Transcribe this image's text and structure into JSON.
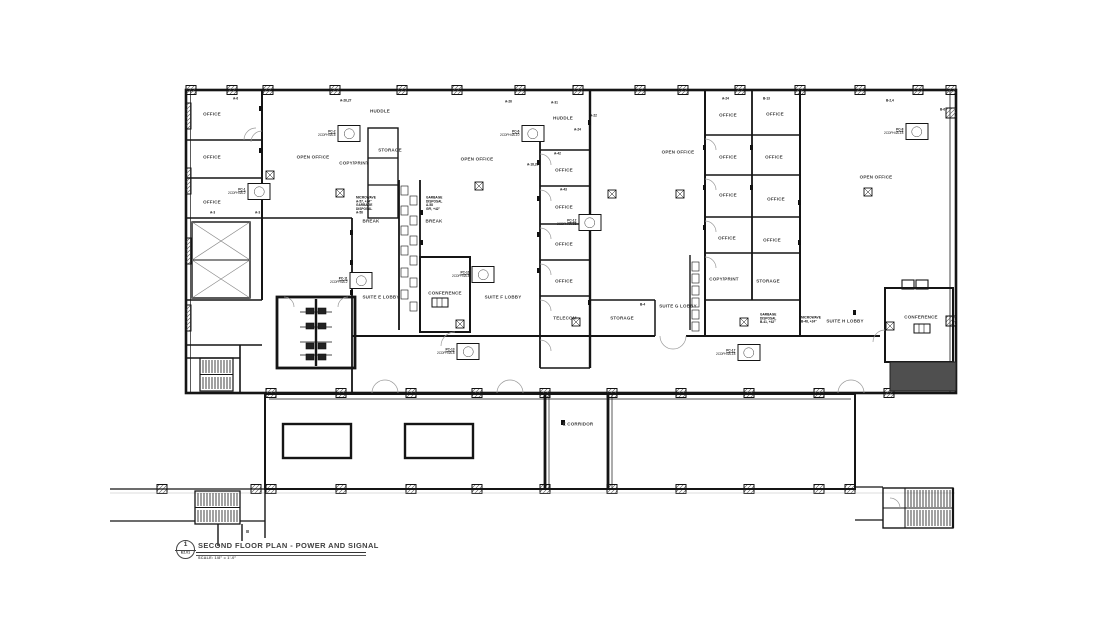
{
  "sheet": {
    "background": "#ffffff",
    "ink": "#1a1a1a",
    "muted": "#8a8a8a",
    "fill_dark": "#4f4f4f"
  },
  "title_block": {
    "detail_number": "1",
    "sheet_ref": "E2.01",
    "title": "SECOND FLOOR PLAN - POWER AND SIGNAL",
    "scale": "SCALE: 1/8\" = 1'-0\""
  },
  "rooms": [
    {
      "label": "OFFICE",
      "x": 212,
      "y": 114
    },
    {
      "label": "OFFICE",
      "x": 212,
      "y": 157
    },
    {
      "label": "OFFICE",
      "x": 212,
      "y": 202
    },
    {
      "label": "HUDDLE",
      "x": 380,
      "y": 111
    },
    {
      "label": "OPEN OFFICE",
      "x": 313,
      "y": 157
    },
    {
      "label": "COPY/PRINT",
      "x": 354,
      "y": 163
    },
    {
      "label": "STORAGE",
      "x": 390,
      "y": 150
    },
    {
      "label": "BREAK",
      "x": 371,
      "y": 221
    },
    {
      "label": "BREAK",
      "x": 434,
      "y": 221
    },
    {
      "label": "HUDDLE",
      "x": 563,
      "y": 118
    },
    {
      "label": "OPEN OFFICE",
      "x": 477,
      "y": 159
    },
    {
      "label": "OFFICE",
      "x": 564,
      "y": 170
    },
    {
      "label": "OFFICE",
      "x": 564,
      "y": 207
    },
    {
      "label": "OFFICE",
      "x": 564,
      "y": 244
    },
    {
      "label": "OFFICE",
      "x": 564,
      "y": 281
    },
    {
      "label": "TELECOM",
      "x": 565,
      "y": 318
    },
    {
      "label": "CONFERENCE",
      "x": 445,
      "y": 293
    },
    {
      "label": "SUITE E LOBBY",
      "x": 381,
      "y": 297
    },
    {
      "label": "SUITE F LOBBY",
      "x": 503,
      "y": 297
    },
    {
      "label": "OPEN OFFICE",
      "x": 678,
      "y": 152
    },
    {
      "label": "OFFICE",
      "x": 728,
      "y": 115
    },
    {
      "label": "OFFICE",
      "x": 775,
      "y": 114
    },
    {
      "label": "OFFICE",
      "x": 728,
      "y": 157
    },
    {
      "label": "OFFICE",
      "x": 774,
      "y": 157
    },
    {
      "label": "OFFICE",
      "x": 728,
      "y": 195
    },
    {
      "label": "OFFICE",
      "x": 776,
      "y": 199
    },
    {
      "label": "OFFICE",
      "x": 727,
      "y": 238
    },
    {
      "label": "OFFICE",
      "x": 772,
      "y": 240
    },
    {
      "label": "COPY/PRINT",
      "x": 724,
      "y": 279
    },
    {
      "label": "STORAGE",
      "x": 768,
      "y": 281
    },
    {
      "label": "STORAGE",
      "x": 622,
      "y": 318
    },
    {
      "label": "SUITE G LOBBY",
      "x": 678,
      "y": 306
    },
    {
      "label": "SUITE H LOBBY",
      "x": 845,
      "y": 321
    },
    {
      "label": "OPEN OFFICE",
      "x": 876,
      "y": 177
    },
    {
      "label": "CONFERENCE",
      "x": 921,
      "y": 317
    },
    {
      "label": "E CORRIDOR",
      "x": 578,
      "y": 424
    }
  ],
  "annotations": [
    {
      "x": 233,
      "y": 97,
      "lines": [
        "A-6"
      ]
    },
    {
      "x": 340,
      "y": 99,
      "lines": [
        "A-26,27"
      ]
    },
    {
      "x": 505,
      "y": 100,
      "lines": [
        "A-26"
      ]
    },
    {
      "x": 551,
      "y": 101,
      "lines": [
        "A-31"
      ]
    },
    {
      "x": 590,
      "y": 114,
      "lines": [
        "A-22"
      ]
    },
    {
      "x": 574,
      "y": 128,
      "lines": [
        "A-24"
      ]
    },
    {
      "x": 527,
      "y": 163,
      "lines": [
        "A-18,20"
      ]
    },
    {
      "x": 554,
      "y": 152,
      "lines": [
        "A-42"
      ]
    },
    {
      "x": 560,
      "y": 188,
      "lines": [
        "A-43"
      ]
    },
    {
      "x": 722,
      "y": 97,
      "lines": [
        "A-24"
      ]
    },
    {
      "x": 763,
      "y": 97,
      "lines": [
        "B-13"
      ]
    },
    {
      "x": 886,
      "y": 99,
      "lines": [
        "B-2,4"
      ]
    },
    {
      "x": 940,
      "y": 108,
      "lines": [
        "B-6"
      ]
    },
    {
      "x": 210,
      "y": 211,
      "lines": [
        "A-3"
      ]
    },
    {
      "x": 255,
      "y": 211,
      "lines": [
        "A-3"
      ]
    },
    {
      "x": 356,
      "y": 196,
      "lines": [
        "MICROWAVE",
        "A-57, +24\"",
        "GARBAGE",
        "DISPOSAL",
        "A-56"
      ]
    },
    {
      "x": 426,
      "y": 196,
      "lines": [
        "GARBAGE",
        "DISPOSAL",
        "A-58",
        "GFI, +42\""
      ]
    },
    {
      "x": 760,
      "y": 313,
      "lines": [
        "GARBAGE",
        "DISPOSAL",
        "B-41, +42\""
      ]
    },
    {
      "x": 801,
      "y": 316,
      "lines": [
        "MICROWAVE",
        "B-48, +24\""
      ]
    },
    {
      "x": 640,
      "y": 303,
      "lines": [
        "B-4"
      ]
    }
  ],
  "notes": [
    {
      "x": 318,
      "y": 125,
      "tag": "PC-2",
      "sub": "2CDPH4A-6"
    },
    {
      "x": 500,
      "y": 125,
      "tag": "PC-6",
      "sub": "2CDPH4A-10"
    },
    {
      "x": 884,
      "y": 123,
      "tag": "PC-8",
      "sub": "2CDPH4A-18"
    },
    {
      "x": 228,
      "y": 183,
      "tag": "PC-1",
      "sub": "2CDPH4A-2"
    },
    {
      "x": 330,
      "y": 272,
      "tag": "PC-11",
      "sub": "2CDPH4A-2"
    },
    {
      "x": 452,
      "y": 266,
      "tag": "PC-10",
      "sub": "2CDPH4A-8"
    },
    {
      "x": 557,
      "y": 214,
      "tag": "PC-12",
      "sub": "2CDPH4A-16"
    },
    {
      "x": 437,
      "y": 343,
      "tag": "PC-13",
      "sub": "2CDPH4A-8"
    },
    {
      "x": 716,
      "y": 344,
      "tag": "PC-17",
      "sub": "2CDPH4A-18"
    }
  ]
}
